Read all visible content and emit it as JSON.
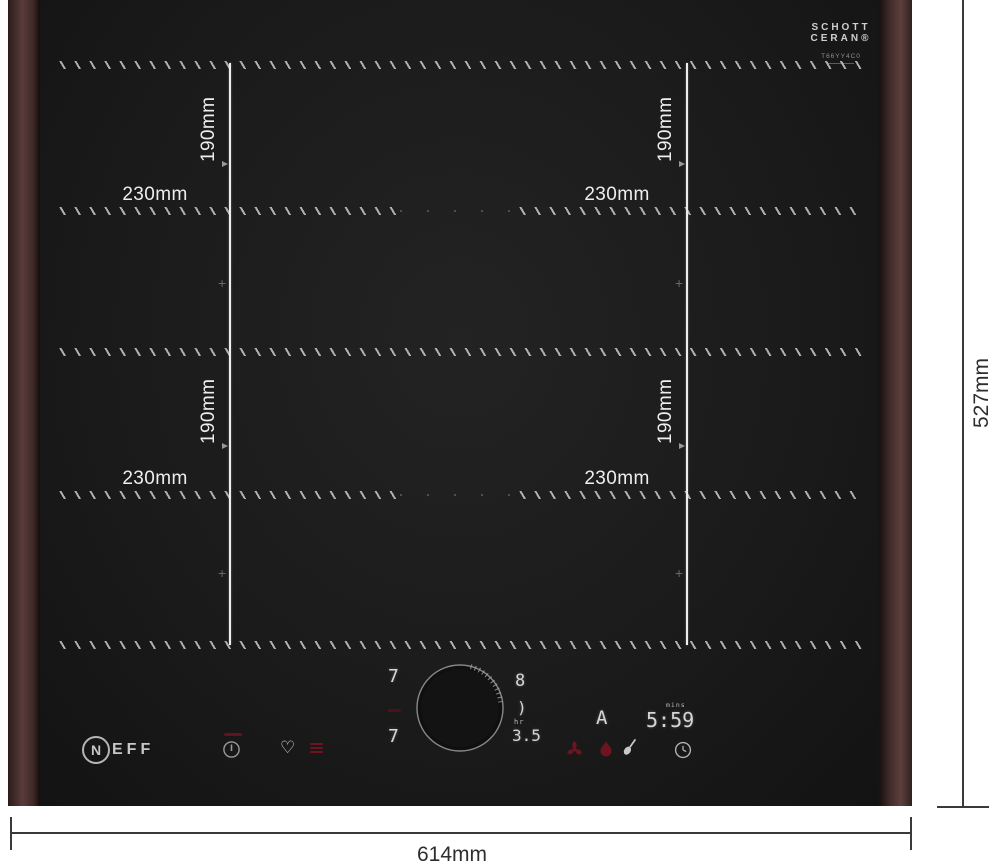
{
  "branding": {
    "glass_brand_line1": "SCHOTT",
    "glass_brand_line2": "CERAN®",
    "glass_model": "T66YY4C0",
    "neff_initial": "N",
    "neff_rest": "EFF"
  },
  "dimensions": {
    "overall_width": "614mm",
    "overall_height": "527mm",
    "zone_width": "230mm",
    "zone_height": "190mm",
    "zone_center_marker": "+"
  },
  "display": {
    "left_zone_top_level": "7",
    "left_zone_bottom_level": "7",
    "right_zone_top_level": "8",
    "right_zone_mid_symbol": ")",
    "timer_hours_label": "hr",
    "timer_hours_value": "3.5",
    "auto_indicator": "A",
    "timer_minutes_label": "mins",
    "timer_minutes_value": "5:59"
  },
  "icons": {
    "heart": "♡"
  },
  "colors": {
    "accent_red": "#6e1420",
    "display_segments": "#d6d6d6",
    "trim_brown": "#553a38",
    "glass_black": "#1c1c1c"
  }
}
